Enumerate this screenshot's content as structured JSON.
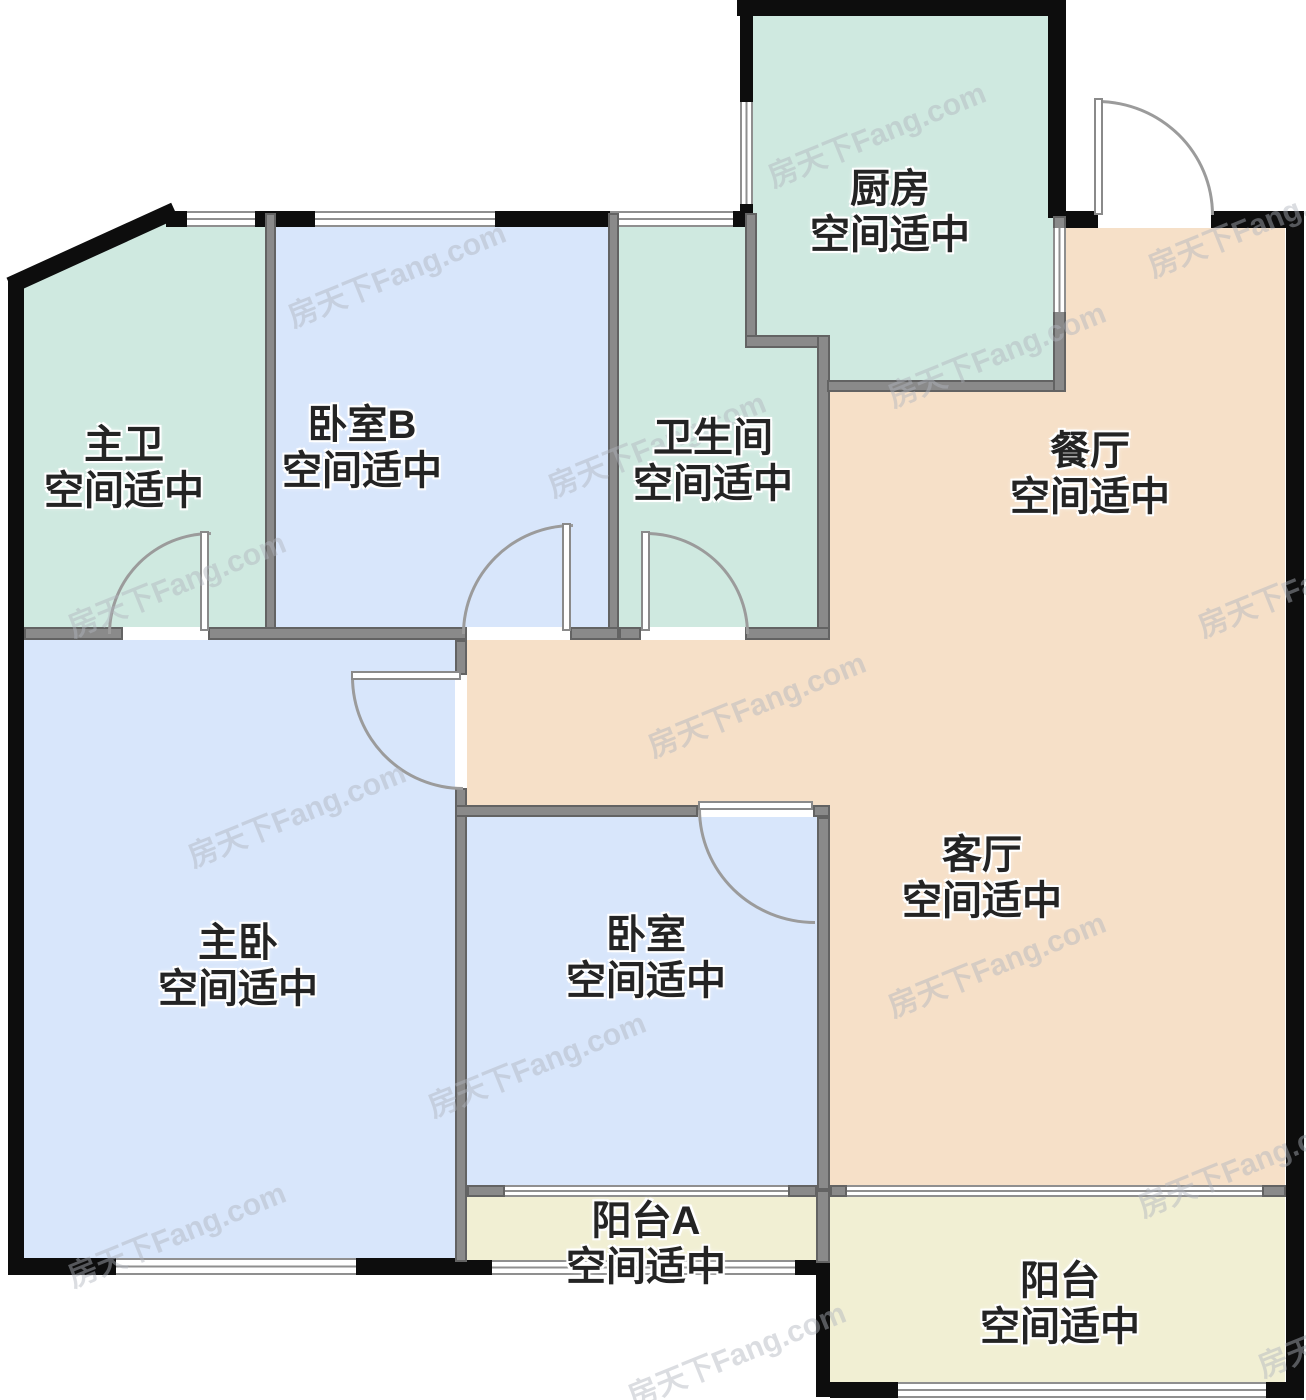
{
  "plan": {
    "type": "apartment-floor-plan"
  },
  "watermark": {
    "text": "房天下Fang.com"
  },
  "rooms": {
    "kitchen": {
      "name": "厨房",
      "status": "空间适中",
      "color": "#cfe9e0"
    },
    "master_bath": {
      "name": "主卫",
      "status": "空间适中",
      "color": "#cfe9e0"
    },
    "bedroom_b": {
      "name": "卧室B",
      "status": "空间适中",
      "color": "#d8e6fb"
    },
    "bathroom": {
      "name": "卫生间",
      "status": "空间适中",
      "color": "#cfe9e0"
    },
    "dining": {
      "name": "餐厅",
      "status": "空间适中",
      "color": "#f6e0c8"
    },
    "master_bedroom": {
      "name": "主卧",
      "status": "空间适中",
      "color": "#d8e6fb"
    },
    "bedroom": {
      "name": "卧室",
      "status": "空间适中",
      "color": "#d8e6fb"
    },
    "living": {
      "name": "客厅",
      "status": "空间适中",
      "color": "#f6e0c8"
    },
    "balcony_a": {
      "name": "阳台A",
      "status": "空间适中",
      "color": "#f1efd3"
    },
    "balcony": {
      "name": "阳台",
      "status": "空间适中",
      "color": "#f1efd3"
    }
  },
  "colors": {
    "wall_exterior": "#0d0d0d",
    "wall_interior": "#8a8a8a",
    "door_arc": "#9b9b9b",
    "label_text": "#242424",
    "background": "#ffffff"
  }
}
